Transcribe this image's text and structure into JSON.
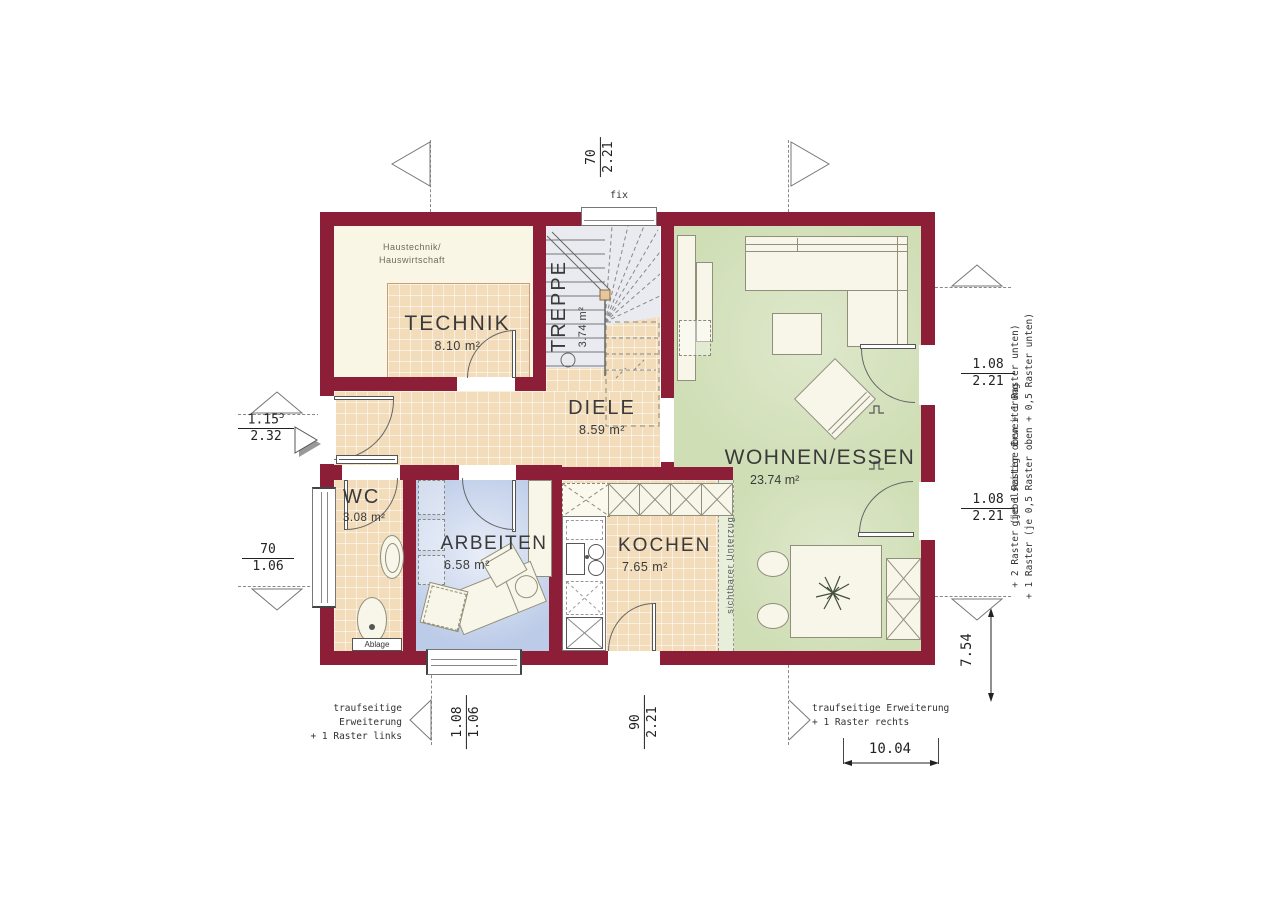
{
  "colors": {
    "wall": "#8c1f37",
    "tile": "#f2dcba",
    "cream": "#f9f6e5",
    "green": "#cfdeb5",
    "blue": "#bccbe8",
    "stairs": "#e9ebf1",
    "furn": "#f8f6e8",
    "furnline": "#8f8f7c"
  },
  "rooms": {
    "technik": {
      "name": "TECHNIK",
      "area": "8.10 m²",
      "note1": "Haustechnik/",
      "note2": "Hauswirtschaft"
    },
    "treppe": {
      "name": "TREPPE",
      "area": "3.74 m²"
    },
    "diele": {
      "name": "DIELE",
      "area": "8.59 m²"
    },
    "wohnen": {
      "name": "WOHNEN/ESSEN",
      "area": "23.74 m²"
    },
    "wc": {
      "name": "WC",
      "area": "3.08 m²"
    },
    "arbeiten": {
      "name": "ARBEITEN",
      "area": "6.58 m²"
    },
    "kochen": {
      "name": "KOCHEN",
      "area": "7.65 m²"
    }
  },
  "labels": {
    "fix": "fix",
    "ablage": "Ablage",
    "unterzug": "sichtbarer Unterzug"
  },
  "dims": {
    "top_window": {
      "num": "70",
      "den": "2.21"
    },
    "entrance": {
      "num": "1.15",
      "sup": "5",
      "den": "2.32"
    },
    "wc_window": {
      "num": "70",
      "den": "1.06"
    },
    "terrace_upper": {
      "num": "1.08",
      "den": "2.21"
    },
    "terrace_lower": {
      "num": "1.08",
      "den": "2.21"
    },
    "arbeiten_window": {
      "num": "1.08",
      "den": "1.06"
    },
    "kochen_door": {
      "num": "90",
      "den": "2.21"
    },
    "total_width": "10.04",
    "total_depth": "7.54"
  },
  "annotations": {
    "trauf_links_1": "traufseitige Erweiterung",
    "trauf_links_2": "+ 1 Raster links",
    "trauf_rechts_1": "traufseitige Erweiterung",
    "trauf_rechts_2": "+ 1 Raster rechts",
    "giebel_1": "giebelseitige Erweiterung",
    "giebel_2": "+ 1 Raster (je 0,5 Raster oben + 0,5 Raster unten)",
    "giebel_3": "+ 2 Raster (je 1 Raster oben + 1 Raster unten)"
  }
}
